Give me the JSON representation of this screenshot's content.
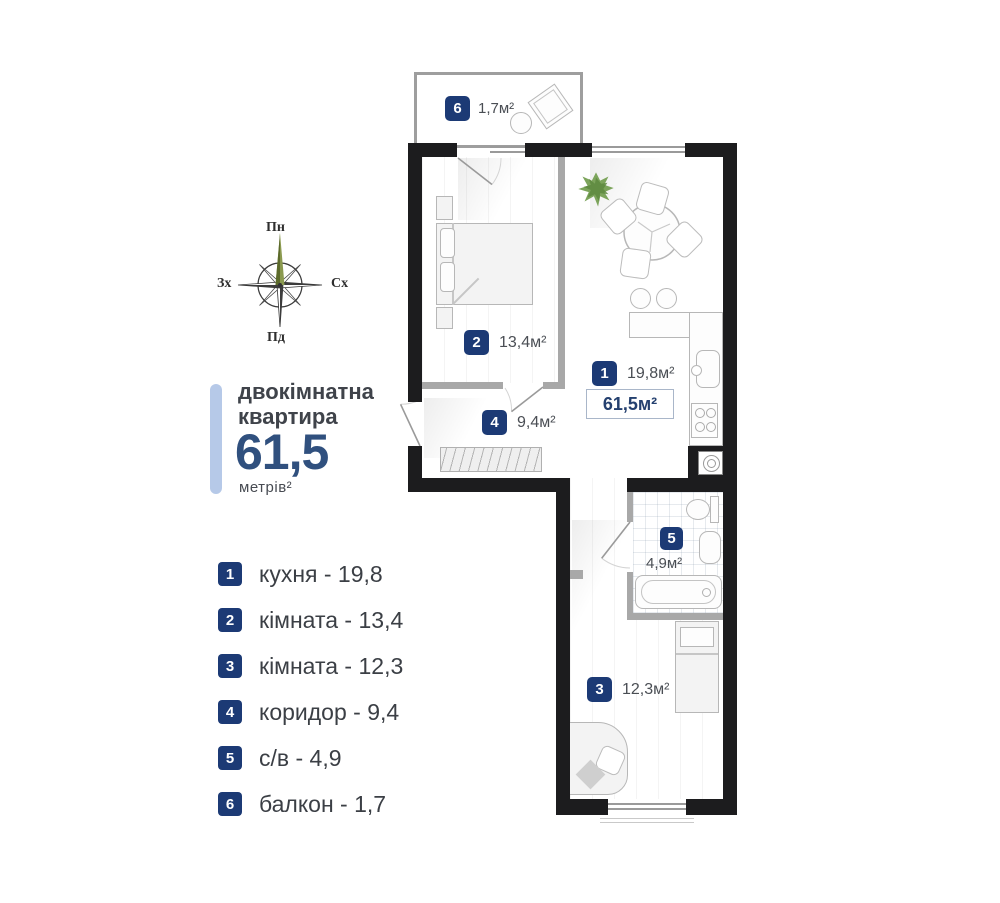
{
  "colors": {
    "wall": "#1c1c1e",
    "interior_wall": "#a8a8a8",
    "badge_navy": "#1c3a75",
    "accent_blue": "#30507e",
    "title_bar_blue": "#b6c9e8",
    "text_dark": "#3b3f45",
    "plant_green": "#6f9c4d"
  },
  "compass": {
    "north": "Пн",
    "east": "Сх",
    "south": "Пд",
    "west": "Зх"
  },
  "title": {
    "line1": "двокімнатна",
    "line2": "квартира",
    "value": "61,5",
    "unit": "метрів²"
  },
  "legend": [
    {
      "num": "1",
      "label": "кухня - 19,8"
    },
    {
      "num": "2",
      "label": "кімната - 13,4"
    },
    {
      "num": "3",
      "label": "кімната - 12,3"
    },
    {
      "num": "4",
      "label": "коридор - 9,4"
    },
    {
      "num": "5",
      "label": "с/в - 4,9"
    },
    {
      "num": "6",
      "label": "балкон - 1,7"
    }
  ],
  "plan": {
    "total_area": "61,5м²",
    "rooms": [
      {
        "num": "1",
        "area": "19,8м²"
      },
      {
        "num": "2",
        "area": "13,4м²"
      },
      {
        "num": "3",
        "area": "12,3м²"
      },
      {
        "num": "4",
        "area": "9,4м²"
      },
      {
        "num": "5",
        "area": "4,9м²"
      },
      {
        "num": "6",
        "area": "1,7м²"
      }
    ]
  }
}
